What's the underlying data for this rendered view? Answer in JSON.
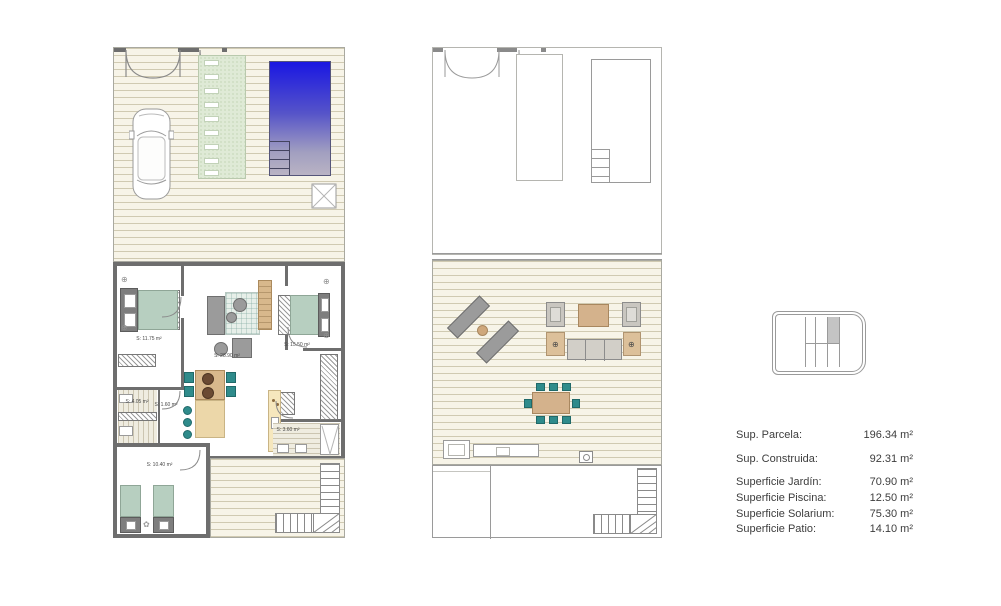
{
  "sheet": {
    "background": "#ffffff"
  },
  "legend": {
    "rows": [
      {
        "label": "Sup. Parcela:",
        "value": "196.34 m²"
      },
      {
        "label": "Sup. Construida:",
        "value": "92.31 m²"
      },
      {
        "label": "Superficie Jardín:",
        "value": "70.90 m²"
      },
      {
        "label": "Superficie Piscina:",
        "value": "12.50 m²"
      },
      {
        "label": "Superficie Solarium:",
        "value": "75.30 m²"
      },
      {
        "label": "Superficie Patio:",
        "value": "14.10 m²"
      }
    ]
  },
  "plan_ground": {
    "rooms": [
      {
        "id": "bedroom-1",
        "area_label": "S: 11.75 m²"
      },
      {
        "id": "living-kitchen",
        "area_label": "S: 28.90 m²"
      },
      {
        "id": "bedroom-2",
        "area_label": "S: 15.50 m²"
      },
      {
        "id": "bathroom-1",
        "area_label": "S: 4.05 m²"
      },
      {
        "id": "hall",
        "area_label": "S: 1.60 m²"
      },
      {
        "id": "bathroom-2",
        "area_label": "S: 3.60 m²"
      },
      {
        "id": "bedroom-3",
        "area_label": "S: 10.40 m²"
      }
    ]
  },
  "icons": {
    "rosette": "⊕",
    "flower": "✿"
  },
  "colors": {
    "wall": "#6e6e6e",
    "pool_top": "#1a17e2",
    "pool_mid": "#5553c9",
    "pool_low": "#a29fc0",
    "pool_bottom": "#b9b3c4",
    "garden_path": "#dfead6",
    "bed_green": "#b7cfc0",
    "teal_chair": "#2f8b8b",
    "wood": "#d8b88c",
    "counter": "#f6e7bd",
    "gray_furniture": "#9b9b9b",
    "key_highlight": "#c4c4c4"
  }
}
